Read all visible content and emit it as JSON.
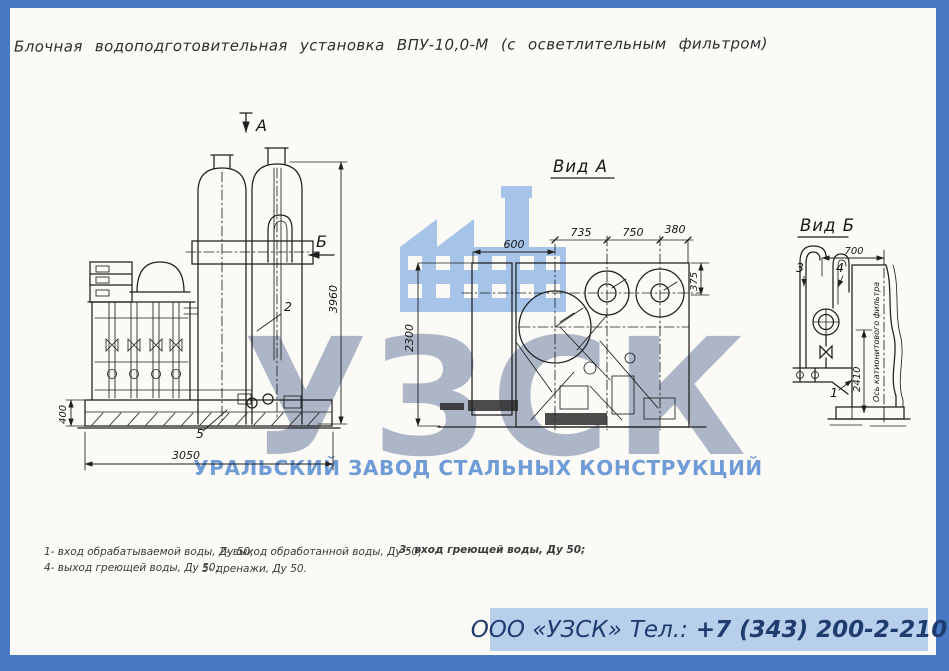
{
  "page": {
    "title": "Блочная водоподготовительная установка ВПУ-10,0-М (с осветлительным фильтром)"
  },
  "watermark": {
    "logo_letters": "УЗСК",
    "company_line": "УРАЛЬСКИЙ ЗАВОД СТАЛЬНЫХ КОНСТРУКЦИЙ",
    "icon": "factory-icon",
    "colors": {
      "factory_icon": "#a6c4e8",
      "logo_letters": "#a7b1c2",
      "company_line": "#6f9cd6"
    }
  },
  "views": {
    "main": {
      "arrow_a": "А",
      "arrow_b": "Б",
      "dim_height": "3960",
      "dim_base": "400",
      "dim_width": "3050",
      "label_2": "2",
      "label_5": "5"
    },
    "view_a": {
      "title": "Вид А",
      "dim_600": "600",
      "dim_735": "735",
      "dim_750": "750",
      "dim_380": "380",
      "dim_2300": "2300",
      "dim_375": "375"
    },
    "view_b": {
      "title": "Вид Б",
      "dim_700": "700",
      "dim_2410": "2410",
      "axis_label": "Ось катионитового фильтра",
      "label_1": "1",
      "label_3": "3",
      "label_4": "4"
    }
  },
  "legend": {
    "items": [
      "1- вход обрабатываемой воды, Ду 50;",
      "2- выход обработанной воды, Ду 50;",
      "3- вход греющей воды, Ду 50;",
      "4- выход греющей воды, Ду 50;",
      "5- дренажи, Ду 50."
    ]
  },
  "footer": {
    "company": "ООО «УЗСК»",
    "tel_label": "Тел.:",
    "phone": "+7 (343) 200-2-210",
    "colors": {
      "bar_bg": "#b8cfeb",
      "text": "#1e3c6e",
      "border": "#4678c4"
    }
  }
}
